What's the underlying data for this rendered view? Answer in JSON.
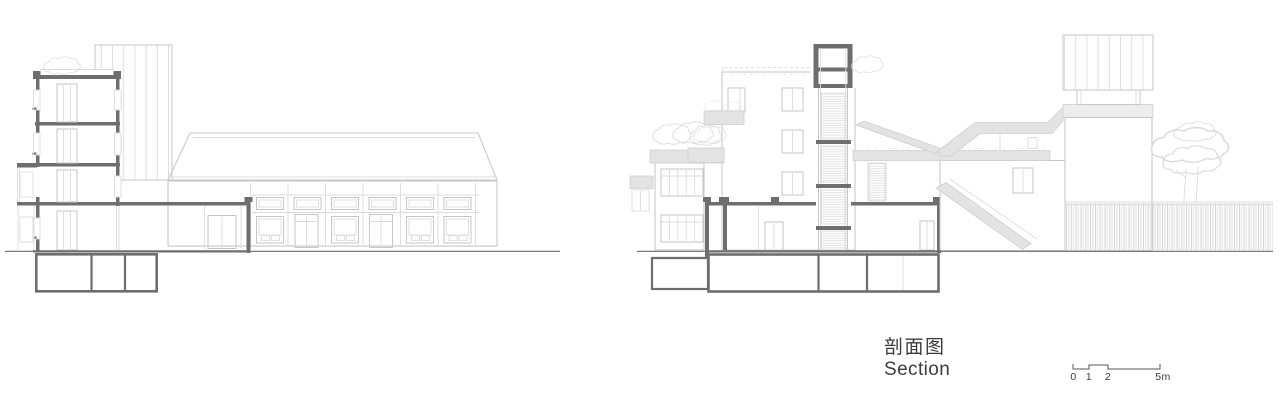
{
  "meta": {
    "width": 1280,
    "height": 413
  },
  "colors": {
    "cut": "#6e6e6e",
    "line": "#c6c6c6",
    "faint": "#dcdcdc",
    "hatch": "#d8d8d8",
    "slab_fill": "#e3e3e3",
    "panel_fill": "#ededed",
    "ground": "#7d7d7d",
    "text": "#3c3c3c",
    "background": "#ffffff"
  },
  "caption": {
    "chinese": "剖面图",
    "english": "Section"
  },
  "scale_bar": {
    "labels": [
      "0",
      "1",
      "2",
      "5m"
    ]
  }
}
